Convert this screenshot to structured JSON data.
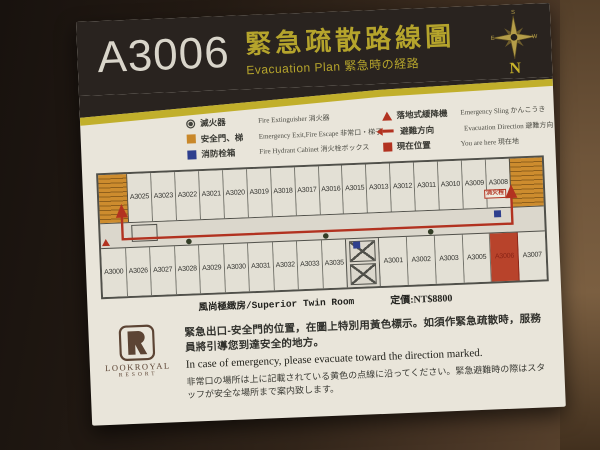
{
  "header": {
    "room_number": "A3006",
    "title_zh": "緊急疏散路線圖",
    "subtitle": "Evacuation Plan 緊急時の経路",
    "compass": {
      "north": "N",
      "south": "S",
      "east": "E",
      "west": "W"
    }
  },
  "legend": {
    "items": [
      {
        "zh": "滅火器",
        "en": "Fire Extinguisher 消火器"
      },
      {
        "zh": "安全門、梯",
        "en": "Emergency Exit,Fire Escape 非常口・梯子"
      },
      {
        "zh": "消防栓箱",
        "en": "Fire Hydrant Cabinet 消火栓ボックス"
      },
      {
        "zh": "落地式緩降機",
        "en": "Emergency Sling かんこうき"
      },
      {
        "zh": "避難方向",
        "en": "Evacuation Direction 避難方向"
      },
      {
        "zh": "現在位置",
        "en": "You are here 現在地"
      }
    ]
  },
  "floorplan": {
    "top_row": [
      "A3025",
      "A3023",
      "A3022",
      "A3021",
      "A3020",
      "A3019",
      "A3018",
      "A3017",
      "A3016",
      "A3015",
      "A3013",
      "A3012",
      "A3011",
      "A3010",
      "A3009",
      "A3008"
    ],
    "bottom_row_left": [
      "A3000",
      "A3026",
      "A3027",
      "A3028",
      "A3029",
      "A3030",
      "A3031",
      "A3032",
      "A3033",
      "A3035"
    ],
    "bottom_row_right": [
      {
        "label": "A3001"
      },
      {
        "label": "A3002"
      },
      {
        "label": "A3003"
      },
      {
        "label": "A3005"
      },
      {
        "label": "A3006",
        "highlight": true
      },
      {
        "label": "A3007"
      }
    ],
    "highlight_room": "A3006",
    "hydrant_label": "消火栓",
    "caption_room_type": "風尚極緻房/Superior Twin Room",
    "caption_price": "定價:NT$8800"
  },
  "footer": {
    "logo_name": "LOOKROYAL",
    "logo_sub": "RESORT",
    "notice_zh": "緊急出口-安全門的位置，在圖上特別用黃色標示。如須作緊急疏散時，服務員將引導您到達安全的地方。",
    "notice_en": "In case of emergency, please evacuate toward the direction marked.",
    "notice_ja": "非常口の場所は上に記載されている黄色の点線に沿ってください。緊急避難時の際はスタッフが安全な場所まで案内致します。"
  },
  "colors": {
    "plaque_bg": "#e9e5da",
    "header_bg": "#29231f",
    "accent_yellow": "#b5a42c",
    "route_red": "#b23220",
    "exit_orange": "#c9882a",
    "hydrant_blue": "#2e3f8e",
    "highlight_room_red": "#b8432b"
  }
}
